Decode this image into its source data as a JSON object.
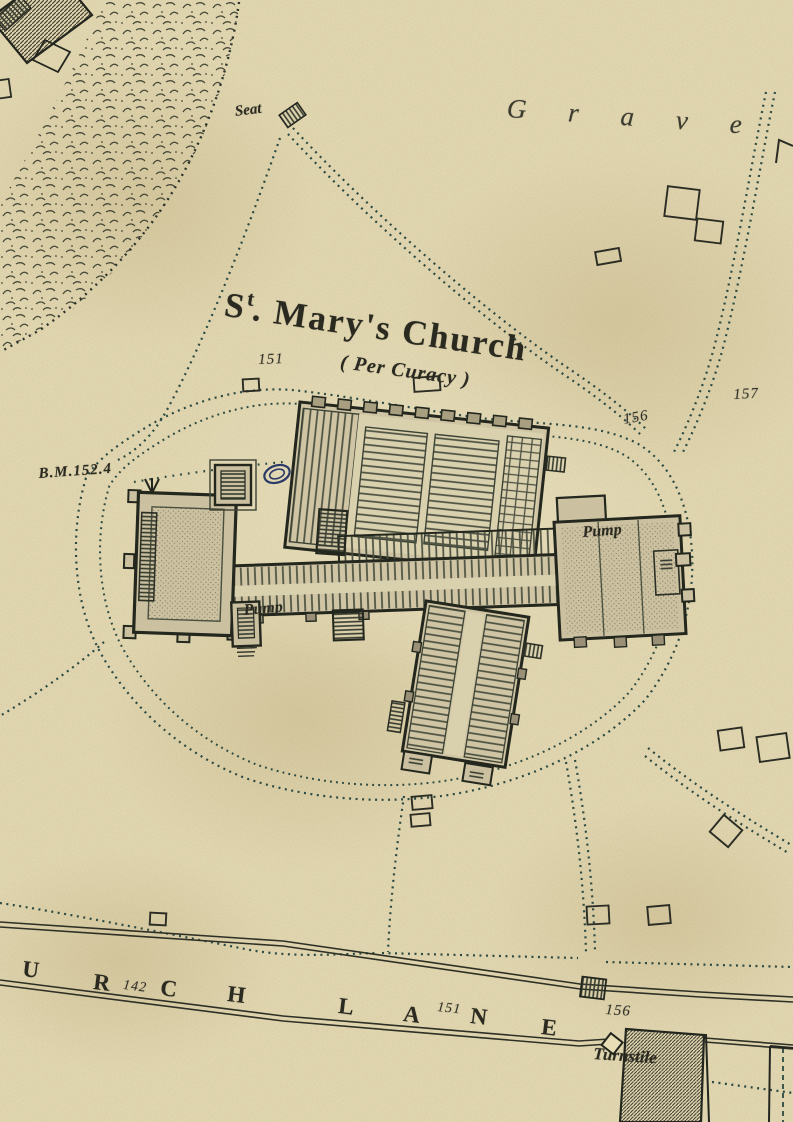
{
  "map": {
    "title": {
      "prefix": "S",
      "sup": "t",
      "rest": ". Mary's Church",
      "full": "St. Mary's Church"
    },
    "subtitle": "( Per Curacy )",
    "area_label": "Grave",
    "labels": {
      "seat": "Seat",
      "benchmark": "B.M.152.4",
      "pump_west": "Pump",
      "pump_east": "Pump",
      "turnstile": "Turnstile"
    },
    "spot_heights": {
      "near_church_nw": "151",
      "near_church_e": "156",
      "near_church_ne": "157",
      "lane_west": "142",
      "lane_mid": "151",
      "lane_east": "156"
    },
    "lane": {
      "name": "CHURCH LANE",
      "letters": [
        "U",
        "R",
        "C",
        "H",
        "L",
        "A",
        "N",
        "E"
      ]
    },
    "colors": {
      "paper": "#e8ddb5",
      "ink": "#2b2a21",
      "path_ink": "#2e4a42",
      "building_fill": "#cfc5a4",
      "aisle_fill": "#d9d0ae",
      "oval_ink": "#2b3a66"
    }
  }
}
